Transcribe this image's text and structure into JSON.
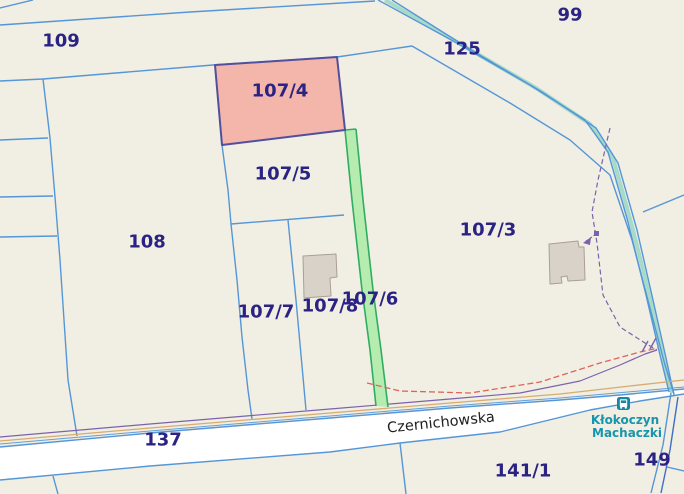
{
  "map": {
    "width": 684,
    "height": 494,
    "selected_parcel_label": "107/4",
    "street_name": "Czernichowska",
    "locality": {
      "line1": "Kłokoczyn",
      "line2": "Machaczki"
    },
    "colors": {
      "background": "#f1eee3",
      "parcel_line_blue": "#5596d8",
      "parcel_line_dark_blue": "#3f6fc4",
      "label_navy": "#2b2383",
      "selected_fill": "#f4b5aa",
      "selected_stroke": "#50509f",
      "green_strip_fill": "#b7ecb1",
      "green_strip_stroke": "#2fae62",
      "path_teal": "#9ed8c4",
      "utility_tan": "#d8ab70",
      "utility_purple": "#7b62ae",
      "utility_red": "#e0635a",
      "building_fill": "#d8d2c8",
      "building_stroke": "#a9a093",
      "road_fill": "#ffffff",
      "locality_teal": "#1795ad",
      "street_text": "#202020",
      "bus_icon": "#1787a0"
    },
    "shapes": [
      {
        "t": "poly",
        "name": "road-czernichowska-surface",
        "pts": "0,447 150,433 330,418 450,408 560,400 620,395 684,389 684,394 640,401 590,410 500,432 400,443 330,452 150,466 0,480",
        "fill": "#ffffff"
      },
      {
        "t": "line",
        "name": "road-czernichowska-top-edge",
        "pts": "0,447 150,433 330,418 450,408 560,400 620,395 684,389",
        "color": "#5596d8",
        "w": 1.4
      },
      {
        "t": "line",
        "name": "road-czernichowska-bottom-edge",
        "pts": "0,480 150,466 330,452 400,443 500,432 590,410 640,401 684,394",
        "color": "#5596d8",
        "w": 1.4
      },
      {
        "t": "line",
        "name": "road-125-path-teal",
        "pts": "385,0 462,45 536,88 590,124 613,158 632,226 650,298 663,357 672,393",
        "color": "#9ed8c4",
        "w": 4,
        "o": 0.9
      },
      {
        "t": "line",
        "name": "corner-line-topleft",
        "pts": "0,8 33,0",
        "color": "#5596d8",
        "w": 1.4
      },
      {
        "t": "line",
        "name": "boundary-109-north",
        "pts": "0,25 190,12 375,1",
        "color": "#5596d8",
        "w": 1.4
      },
      {
        "t": "line",
        "name": "boundary-109-108",
        "pts": "0,81 43,79 213,65 337,57 412,46",
        "color": "#5596d8",
        "w": 1.4
      },
      {
        "t": "line",
        "name": "boundary-left-vertical",
        "pts": "43,79 50,138 55,197 60,260 68,380 77,436",
        "color": "#5596d8",
        "w": 1.4
      },
      {
        "t": "line",
        "name": "left-strip-divider-1",
        "pts": "0,140 48,138",
        "color": "#5596d8",
        "w": 1.4
      },
      {
        "t": "line",
        "name": "left-strip-divider-2",
        "pts": "0,197 53,196",
        "color": "#5596d8",
        "w": 1.4
      },
      {
        "t": "line",
        "name": "left-strip-divider-3",
        "pts": "0,237 57,236",
        "color": "#5596d8",
        "w": 1.4
      },
      {
        "t": "line",
        "name": "boundary-108-east",
        "pts": "222,145 228,190 231,224 237,280 242,337 248,390 252,419",
        "color": "#5596d8",
        "w": 1.4
      },
      {
        "t": "line",
        "name": "boundary-1075-south",
        "pts": "231,224 344,215",
        "color": "#5596d8",
        "w": 1.4
      },
      {
        "t": "line",
        "name": "divider-1077-1078",
        "pts": "288,220 296,300 306,410",
        "color": "#5596d8",
        "w": 1.4
      },
      {
        "t": "line",
        "name": "road-125-edge-west",
        "pts": "378,0 455,42 530,85 585,120 608,152 628,222 646,295 660,355 669,392",
        "color": "#5596d8",
        "w": 1.4
      },
      {
        "t": "line",
        "name": "road-125-edge-east",
        "pts": "392,0 468,48 542,92 596,128 618,163 637,230 653,300 666,358 674,395",
        "color": "#5596d8",
        "w": 1.4
      },
      {
        "t": "line",
        "name": "boundary-1073-northeast",
        "pts": "412,46 510,103 570,140 610,175 632,240 650,308 665,365 674,394",
        "color": "#5596d8",
        "w": 1.4
      },
      {
        "t": "line",
        "name": "boundary-right-edge",
        "pts": "684,195 643,212",
        "color": "#5596d8",
        "w": 1.4
      },
      {
        "t": "line",
        "name": "below-road-divider-west",
        "pts": "53,476 58,494",
        "color": "#5596d8",
        "w": 1.4
      },
      {
        "t": "line",
        "name": "boundary-1411-west",
        "pts": "400,443 406,494",
        "color": "#5596d8",
        "w": 1.4
      },
      {
        "t": "line",
        "name": "boundary-149-west",
        "pts": "671,393 663,445 651,493",
        "color": "#5596d8",
        "w": 1.4
      },
      {
        "t": "line",
        "name": "boundary-149-east",
        "pts": "678,397 670,450 661,493",
        "color": "#3f6fc4",
        "w": 1.4
      },
      {
        "t": "line",
        "name": "boundary-149-south",
        "pts": "667,467 684,471",
        "color": "#5596d8",
        "w": 1.4
      },
      {
        "t": "line",
        "name": "utility-line-blue",
        "pts": "0,444 150,431 330,416 450,406 560,398 684,387",
        "color": "#5596d8",
        "w": 1,
        "o": 0.9
      },
      {
        "t": "line",
        "name": "utility-line-tan",
        "pts": "0,441 150,428 330,413 450,403 560,394 630,386 684,380",
        "color": "#d8ab70",
        "w": 1.3
      },
      {
        "t": "line",
        "name": "utility-line-purple",
        "pts": "0,437 150,424 330,409 450,399 520,393 580,381 620,365 645,354 657,350",
        "color": "#7b62ae",
        "w": 1.2
      },
      {
        "t": "line",
        "name": "utility-line-purple-vertical",
        "pts": "610,128 598,180 592,212 597,243 603,295 620,327 645,343 657,350",
        "color": "#7b62ae",
        "w": 1.2,
        "dash": "5,3"
      },
      {
        "t": "poly",
        "name": "parcel-1076-green-strip",
        "pts": "345,130 352,200 362,290 370,350 376,406 388,407 381,350 373,290 363,200 356,129",
        "fill": "#b7ecb1"
      },
      {
        "t": "line",
        "name": "green-strip-west-edge",
        "pts": "345,130 352,200 362,290 370,350 376,406",
        "color": "#2fae62",
        "w": 1.6
      },
      {
        "t": "line",
        "name": "green-strip-east-edge",
        "pts": "356,129 363,200 373,290 381,350 388,407",
        "color": "#2fae62",
        "w": 1.6
      },
      {
        "t": "line",
        "name": "green-strip-north-cap",
        "pts": "345,130 356,129",
        "color": "#2fae62",
        "w": 1.6
      },
      {
        "t": "line",
        "name": "utility-line-red",
        "pts": "367,383 400,391 470,393 540,382 600,363 640,352 658,348",
        "color": "#e0635a",
        "w": 1.3,
        "dash": "6,3"
      },
      {
        "t": "poly",
        "name": "selected-parcel-1074",
        "pts": "215,65 337,57 345,130 222,145",
        "fill": "#f4b5aa",
        "stroke": "#50509f",
        "w": 2,
        "click": true
      },
      {
        "t": "poly",
        "name": "building-1078",
        "pts": "303,256 336,254 337,277 330,278 331,296 304,298",
        "fill": "#d8d2c8",
        "stroke": "#a9a093",
        "w": 1
      },
      {
        "t": "poly",
        "name": "building-1073",
        "pts": "549,244 578,241 579,247 584,247 585,280 568,281 567,276 561,277 562,283 550,284",
        "fill": "#d8d2c8",
        "stroke": "#a9a093",
        "w": 1
      },
      {
        "t": "line",
        "name": "purple-leader-line",
        "pts": "596,234 585,242",
        "color": "#7b62ae",
        "w": 1.2,
        "dash": "3,2"
      },
      {
        "t": "poly",
        "name": "purple-leader-arrowhead",
        "pts": "583,243 591,237 590,245",
        "fill": "#7b62ae"
      },
      {
        "t": "poly",
        "name": "purple-node-marker",
        "pts": "594,231 599,231 599,236 594,236",
        "fill": "#7b62ae"
      },
      {
        "t": "line",
        "name": "purple-gate-tick-1",
        "pts": "648,341 642,352",
        "color": "#7b62ae",
        "w": 1.4
      },
      {
        "t": "line",
        "name": "purple-gate-tick-2",
        "pts": "656,338 650,349",
        "color": "#7b62ae",
        "w": 1.4
      }
    ],
    "labels": [
      {
        "name": "parcel-label-109",
        "text": "109",
        "x": 61,
        "y": 41,
        "size": 18,
        "color": "#2b2383",
        "weight": 600
      },
      {
        "name": "parcel-label-99",
        "text": "99",
        "x": 570,
        "y": 15,
        "size": 18,
        "color": "#2b2383",
        "weight": 600
      },
      {
        "name": "parcel-label-125",
        "text": "125",
        "x": 462,
        "y": 49,
        "size": 18,
        "color": "#2b2383",
        "weight": 600
      },
      {
        "name": "parcel-label-107-4",
        "text": "107/4",
        "x": 280,
        "y": 91,
        "size": 18,
        "color": "#2b2383",
        "weight": 600
      },
      {
        "name": "parcel-label-107-5",
        "text": "107/5",
        "x": 283,
        "y": 174,
        "size": 18,
        "color": "#2b2383",
        "weight": 600
      },
      {
        "name": "parcel-label-108",
        "text": "108",
        "x": 147,
        "y": 242,
        "size": 18,
        "color": "#2b2383",
        "weight": 600
      },
      {
        "name": "parcel-label-107-3",
        "text": "107/3",
        "x": 488,
        "y": 230,
        "size": 18,
        "color": "#2b2383",
        "weight": 600
      },
      {
        "name": "parcel-label-107-7",
        "text": "107/7",
        "x": 266,
        "y": 312,
        "size": 18,
        "color": "#2b2383",
        "weight": 600
      },
      {
        "name": "parcel-label-107-8",
        "text": "107/8",
        "x": 330,
        "y": 306,
        "size": 18,
        "color": "#2b2383",
        "weight": 600
      },
      {
        "name": "parcel-label-107-6",
        "text": "107/6",
        "x": 370,
        "y": 299,
        "size": 18,
        "color": "#2b2383",
        "weight": 600
      },
      {
        "name": "parcel-label-137",
        "text": "137",
        "x": 163,
        "y": 440,
        "size": 18,
        "color": "#2b2383",
        "weight": 600
      },
      {
        "name": "parcel-label-141-1",
        "text": "141/1",
        "x": 523,
        "y": 471,
        "size": 18,
        "color": "#2b2383",
        "weight": 600
      },
      {
        "name": "parcel-label-149",
        "text": "149",
        "x": 652,
        "y": 460,
        "size": 18,
        "color": "#2b2383",
        "weight": 600
      },
      {
        "name": "street-label-czernichowska",
        "text": "Czernichowska",
        "x": 441,
        "y": 423,
        "size": 14.5,
        "color": "#202020",
        "weight": 400,
        "rot": -6
      },
      {
        "name": "locality-label-line1",
        "text": "Kłokoczyn",
        "x": 625,
        "y": 420,
        "size": 12,
        "color": "#1795ad",
        "weight": 700
      },
      {
        "name": "locality-label-line2",
        "text": "Machaczki",
        "x": 627,
        "y": 433,
        "size": 12,
        "color": "#1795ad",
        "weight": 700
      }
    ],
    "icons": [
      {
        "name": "bus-stop-icon",
        "x": 617,
        "y": 397,
        "size": 13,
        "color": "#1787a0"
      }
    ]
  }
}
